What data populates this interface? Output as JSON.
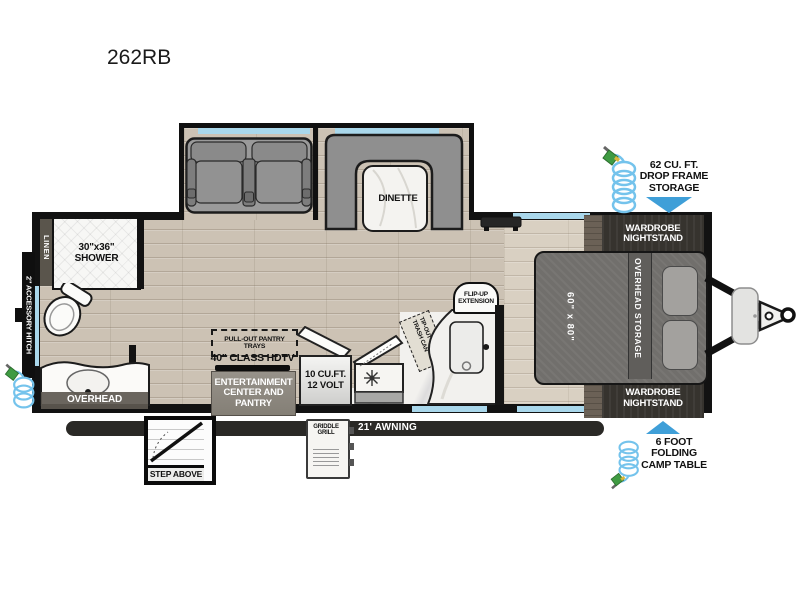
{
  "title": "262RB",
  "plan": {
    "bath": {
      "linen": "LINEN",
      "shower": "30\"x36\"\nSHOWER",
      "overhead": "OVERHEAD",
      "accessory_hitch": "2\" ACCESSORY HITCH"
    },
    "living": {
      "dinette": "DINETTE",
      "pantry_trays": "PULL-OUT PANTRY TRAYS",
      "hdtv": "40\" CLASS HDTV",
      "entertainment": "ENTERTAINMENT\nCENTER AND\nPANTRY"
    },
    "kitchen": {
      "fridge": "10 CU.FT.\n12 VOLT",
      "flip_up": "FLIP-UP\nEXTENSION",
      "trash": "TIP-OUT\nTRASH CAN"
    },
    "bedroom": {
      "bed_size": "60\" x 80\"",
      "overhead_storage": "OVERHEAD STORAGE",
      "wardrobe_top": "WARDROBE\nNIGHTSTAND",
      "wardrobe_bottom": "WARDROBE\nNIGHTSTAND"
    },
    "exterior": {
      "drop_frame": "62 CU. FT.\nDROP FRAME\nSTORAGE",
      "camp_table": "6 FOOT\nFOLDING\nCAMP TABLE",
      "awning": "21' AWNING",
      "griddle": "GRIDDLE\nGRILL",
      "step": "STEP ABOVE"
    }
  },
  "colors": {
    "window": "#a9d7eb",
    "arrow_blue": "#3f9fd8",
    "hose_blue": "#74c3ec",
    "wall_black": "#121212"
  }
}
